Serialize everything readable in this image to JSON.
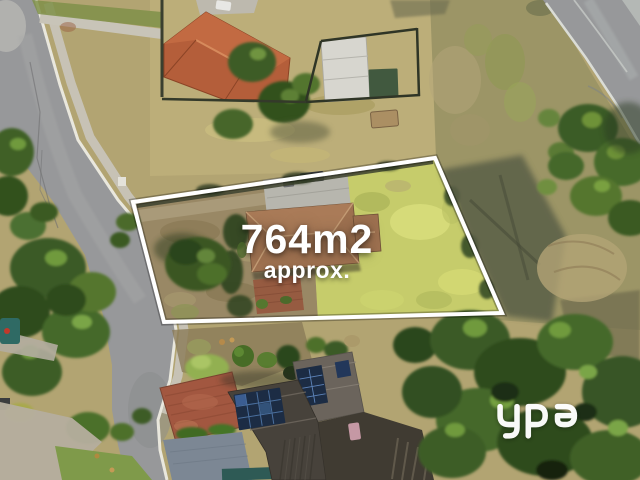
{
  "page": {
    "kind": "real-estate-aerial-listing-photo",
    "width_px": 640,
    "height_px": 480
  },
  "property_overlay": {
    "area_label": "764m2",
    "area_qualifier": "approx.",
    "boundary_points": "133,202 435,158 502,313 164,322",
    "outline_color": "#ffffff",
    "label_color": "#ffffff"
  },
  "watermark": {
    "brand": "ypa",
    "color": "#ffffff"
  },
  "scene": {
    "palette": {
      "road_asphalt": "#97989a",
      "kerb": "#e9e7dd",
      "footpath": "#c8c4b8",
      "dry_grass": "#bcae79",
      "scrub": "#9c9566",
      "dirt": "#998865",
      "lawn_bright": "#c6cc6b",
      "concrete_pad": "#b7b6ae",
      "roof_terracotta": "#b45e3a",
      "roof_subject_house": "#9e7150",
      "roof_dark_house": "#47423b",
      "solar_panel_blue": "#1c2c44",
      "brick_driveway": "#a25740",
      "tree_dark": "#2f4c1e",
      "tree_mid": "#44682a",
      "tree_light": "#6f9a3c"
    }
  }
}
